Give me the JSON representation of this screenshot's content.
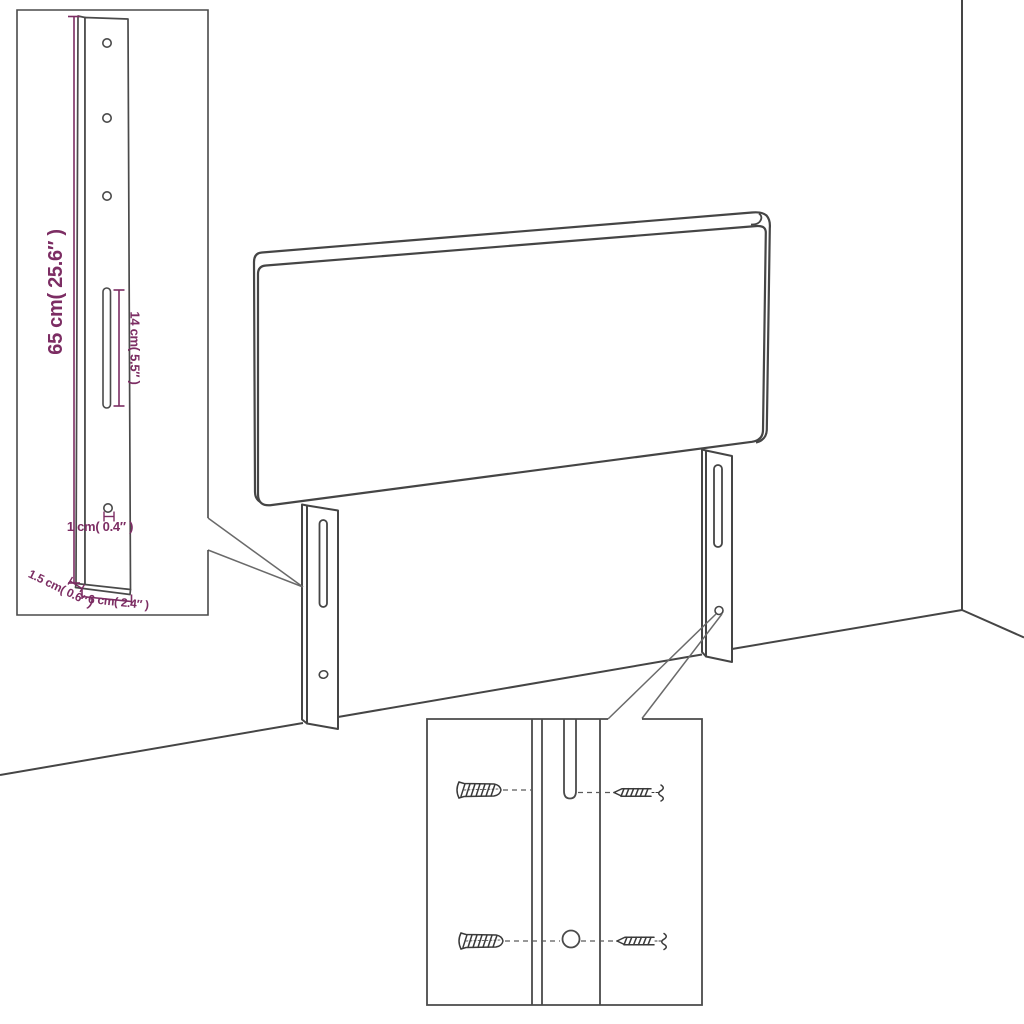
{
  "diagram": {
    "title": "headboard-assembly-diagram",
    "subject": "upholstered headboard with two mounting leg brackets, room corner backdrop",
    "line_color": "#454545",
    "dimension_color": "#7c2d63",
    "dimensions": {
      "leg_height": "65 cm( 25.6″ )",
      "slot_length": "14 cm( 5.5″ )",
      "hole_diameter": "1 cm( 0.4″ )",
      "leg_depth": "1.5 cm( 0.6″ )",
      "leg_width": "6 cm( 2.4″ )"
    },
    "insets": {
      "leg_detail": "leg-bracket-detail-with-three-holes-slot-and-bottom-hole",
      "hardware_detail": "wall-plugs-and-screws-mounting-detail"
    }
  }
}
